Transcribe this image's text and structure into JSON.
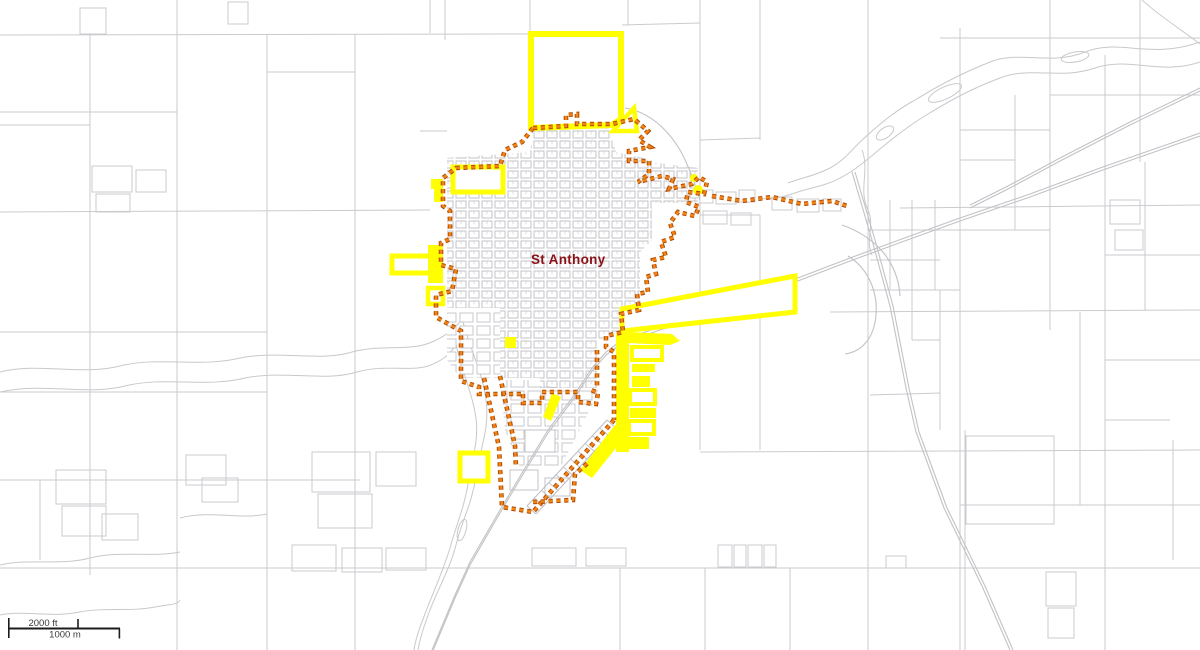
{
  "map": {
    "city_label": "St Anthony"
  },
  "scale_bar": {
    "feet_label": "2000 ft",
    "meters_label": "1000 m"
  },
  "colors": {
    "background": "#ffffff",
    "parcel_line": "#cbcbcf",
    "block_line": "#bdbdc3",
    "road_line": "#c2c2c6",
    "water_line": "#c9c9cd",
    "selected_parcel": "#ffff00",
    "boundary_outer": "#b04a00",
    "boundary_inner": "#ef8318",
    "city_label_color": "#8a1216",
    "scale_bar_color": "#3a3a3a"
  }
}
